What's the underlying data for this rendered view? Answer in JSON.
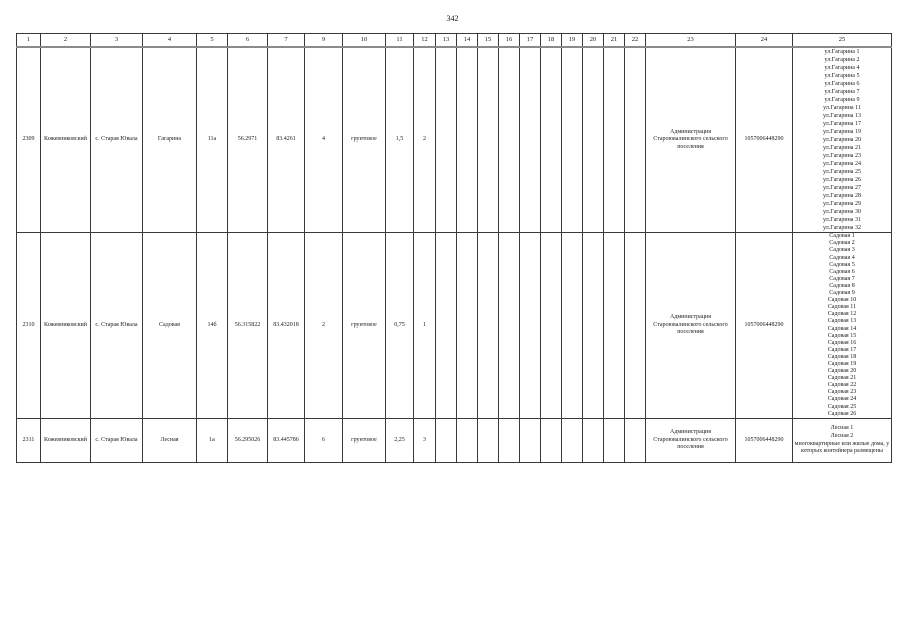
{
  "page": {
    "number": "342"
  },
  "table": {
    "column_numbers": [
      "1",
      "2",
      "3",
      "4",
      "5",
      "6",
      "7",
      "9",
      "10",
      "11",
      "12",
      "13",
      "14",
      "15",
      "16",
      "17",
      "18",
      "19",
      "20",
      "21",
      "22",
      "23",
      "24",
      "25"
    ],
    "rows": [
      {
        "id": "2309",
        "district": "Кожевниковский",
        "settlement": "с. Старая Ювала",
        "street": "Гагарина",
        "house": "11а",
        "latitude": "56.2971",
        "longitude": "83.4261",
        "quantity": "4",
        "surface": "грунтовое",
        "area": "1,5",
        "containers": "2",
        "owner": "Администрация Староювалинского сельского поселения",
        "ogrn": "1057006448290",
        "sources": [
          "ул.Гагарина 1",
          "ул.Гагарина 2",
          "ул.Гагарина 4",
          "ул.Гагарина 5",
          "ул.Гагарина 6",
          "ул.Гагарина 7",
          "ул.Гагарина 9",
          "ул.Гагарина 11",
          "ул.Гагарина 13",
          "ул.Гагарина 17",
          "ул.Гагарина 19",
          "ул.Гагарина 20",
          "ул.Гагарина 21",
          "ул.Гагарина 23",
          "ул.Гагарина 24",
          "ул.Гагарина 25",
          "ул.Гагарина 26",
          "ул.Гагарина 27",
          "ул.Гагарина 28",
          "ул.Гагарина 29",
          "ул.Гагарина 30",
          "ул.Гагарина 31",
          "ул.Гагарина 32"
        ]
      },
      {
        "id": "2310",
        "district": "Кожевниковский",
        "settlement": "с. Старая Ювала",
        "street": "Садовая",
        "house": "14б",
        "latitude": "56.315822",
        "longitude": "83.432018",
        "quantity": "2",
        "surface": "грунтовое",
        "area": "0,75",
        "containers": "1",
        "owner": "Администрация Староювалинского сельского поселения",
        "ogrn": "1057006448290",
        "sources": [
          "Садовая 1",
          "Садовая 2",
          "Садовая 3",
          "Садовая 4",
          "Садовая 5",
          "Садовая 6",
          "Садовая 7",
          "Садовая 8",
          "Садовая 9",
          "Садовая 10",
          "Садовая 11",
          "Садовая 12",
          "Садовая 13",
          "Садовая 14",
          "Садовая 15",
          "Садовая 16",
          "Садовая 17",
          "Садовая 18",
          "Садовая 19",
          "Садовая 20",
          "Садовая 21",
          "Садовая 22",
          "Садовая 23",
          "Садовая 24",
          "Садовая 25",
          "Садовая 26"
        ]
      },
      {
        "id": "2311",
        "district": "Кожевниковский",
        "settlement": "с. Старая Ювала",
        "street": "Лесная",
        "house": "1а",
        "latitude": "56.295026",
        "longitude": "83.445786",
        "quantity": "6",
        "surface": "грунтовое",
        "area": "2,25",
        "containers": "3",
        "owner": "Администрация Староювалинского сельского поселения",
        "ogrn": "1057006448290",
        "sources": [
          "Лесная 1",
          "Лесная 2",
          "многоквартирные или жилые дома, у которых контейнера размещены"
        ]
      }
    ]
  }
}
